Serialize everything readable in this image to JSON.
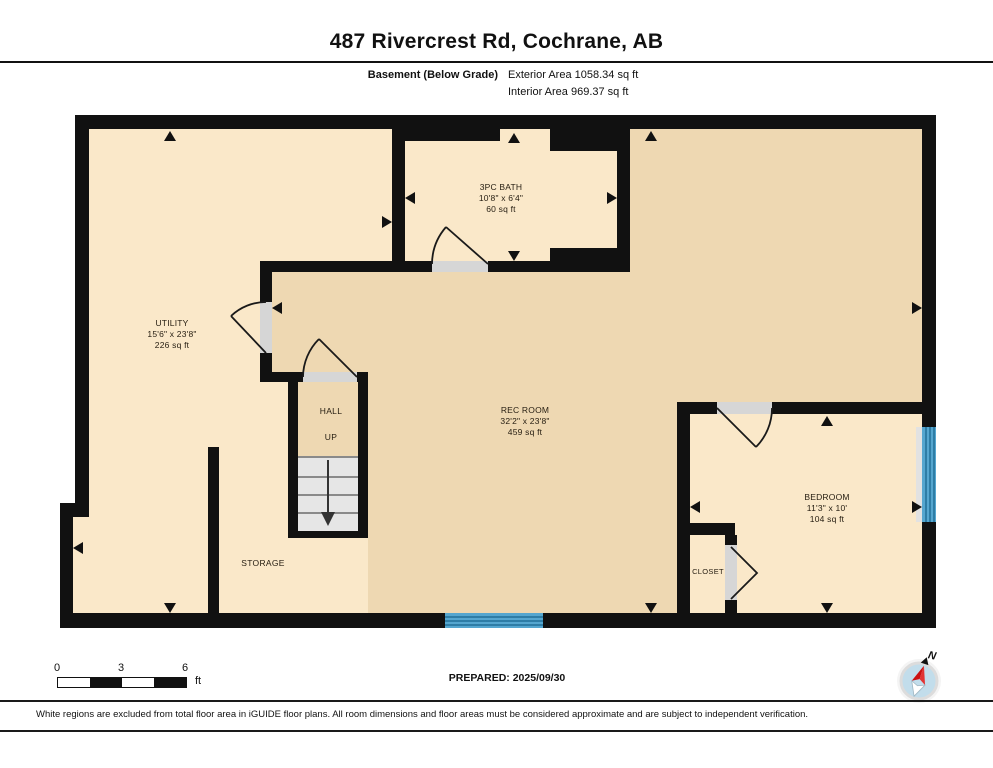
{
  "header": {
    "title": "487 Rivercrest Rd, Cochrane, AB",
    "floor_label": "Basement (Below Grade)",
    "exterior_area": "Exterior Area 1058.34 sq ft",
    "interior_area": "Interior Area 969.37 sq ft"
  },
  "rooms": {
    "utility": {
      "name": "UTILITY",
      "dims": "15'6\" x 23'8\"",
      "area": "226 sq ft"
    },
    "bath": {
      "name": "3PC BATH",
      "dims": "10'8\" x 6'4\"",
      "area": "60 sq ft"
    },
    "rec": {
      "name": "REC ROOM",
      "dims": "32'2\" x 23'8\"",
      "area": "459 sq ft"
    },
    "bedroom": {
      "name": "BEDROOM",
      "dims": "11'3\" x 10'",
      "area": "104 sq ft"
    },
    "hall": {
      "name": "HALL",
      "note": "UP"
    },
    "closet": {
      "name": "CLOSET"
    },
    "storage": {
      "name": "STORAGE"
    }
  },
  "scale_bar": {
    "ticks": [
      "0",
      "3",
      "6"
    ],
    "unit": "ft"
  },
  "prepared": "PREPARED: 2025/09/30",
  "compass": {
    "label": "N"
  },
  "disclaimer": "White regions are excluded from total floor area in iGUIDE floor plans. All room dimensions and floor areas must be considered approximate and are subject to independent verification.",
  "colors": {
    "wall": "#111111",
    "floor_light": "#fae8c9",
    "floor_dark": "#eed8b2",
    "window": "#55a6cf",
    "window_line": "#2e7da6",
    "stairs": "#e6e6e6",
    "door_fill": "#d6d6d6"
  }
}
